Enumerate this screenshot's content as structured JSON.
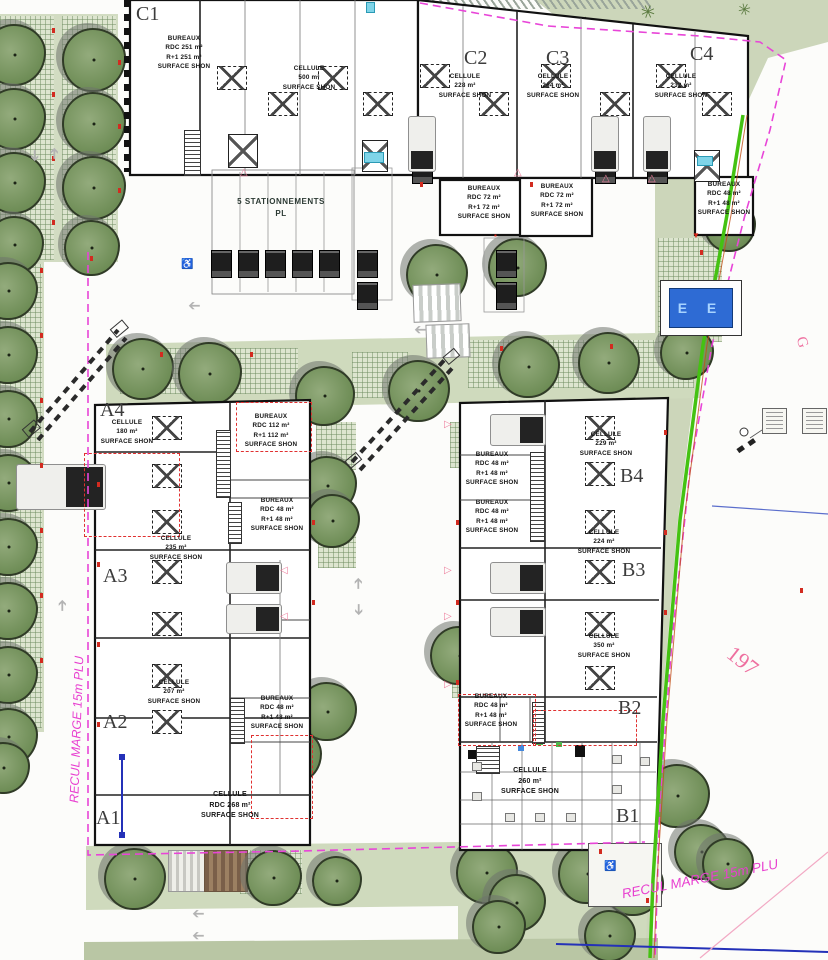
{
  "plan": {
    "margin_left_label": "RECUL MARGE 15m PLU",
    "margin_bottom_label": "RECUL MARGE 15m PLU",
    "parcel_number": "197",
    "road_letter": "G",
    "sign_text": "E E",
    "stationnements": "5 STATIONNEMENTS\nPL",
    "buildings": {
      "c1": {
        "label": "C1",
        "bureaux": "BUREAUX\nRDC 251 m²\nR+1 251 m²\nSURFACE SHON",
        "cellule": "CELLULE\n500 m²\nSURFACE SHON"
      },
      "c2": {
        "label": "C2",
        "cellule": "CELLULE\n228 m²\nSURFACE SHON"
      },
      "c3": {
        "label": "C3",
        "cellule": "CELLULE\n264 m²\nSURFACE SHON"
      },
      "c4": {
        "label": "C4",
        "cellule": "CELLULE\n232 m²\nSURFACE SHON"
      },
      "bureaux_row": {
        "b72a": "BUREAUX\nRDC 72 m²\nR+1 72 m²\nSURFACE SHON",
        "b72b": "BUREAUX\nRDC 72 m²\nR+1 72 m²\nSURFACE SHON",
        "b48": "BUREAUX\nRDC 48 m²\nR+1 48 m²\nSURFACE SHON"
      },
      "a4": {
        "label": "A4",
        "cellule": "CELLULE\n180 m²\nSURFACE SHON",
        "bureaux": "BUREAUX\nRDC 112 m²\nR+1 112 m²\nSURFACE SHON",
        "bureaux2": "BUREAUX\nRDC 48 m²\nR+1 48 m²\nSURFACE SHON"
      },
      "a3": {
        "label": "A3",
        "cellule": "CELLULE\n235 m²\nSURFACE SHON"
      },
      "a2": {
        "label": "A2",
        "cellule": "CELLULE\n207 m²\nSURFACE SHON",
        "bureaux": "BUREAUX\nRDC 48 m²\nR+1 48 m²\nSURFACE SHON"
      },
      "a1": {
        "label": "A1",
        "cellule": "CELLULE\nRDC 268 m²\nSURFACE SHON"
      },
      "b4": {
        "label": "B4",
        "cellule": "CELLULE\n229 m²\nSURFACE SHON",
        "bureaux1": "BUREAUX\nRDC 48 m²\nR+1 48 m²\nSURFACE SHON",
        "bureaux2": "BUREAUX\nRDC 48 m²\nR+1 48 m²\nSURFACE SHON"
      },
      "b3": {
        "label": "B3",
        "cellule": "CELLULE\n224 m²\nSURFACE SHON"
      },
      "b2": {
        "label": "B2",
        "cellule": "CELLULE\n350 m²\nSURFACE SHON",
        "bureaux": "BUREAUX\nRDC 48 m²\nR+1 48 m²\nSURFACE SHON"
      },
      "b1": {
        "label": "B1",
        "cellule": "CELLULE\n260 m²\nSURFACE SHON"
      }
    }
  }
}
